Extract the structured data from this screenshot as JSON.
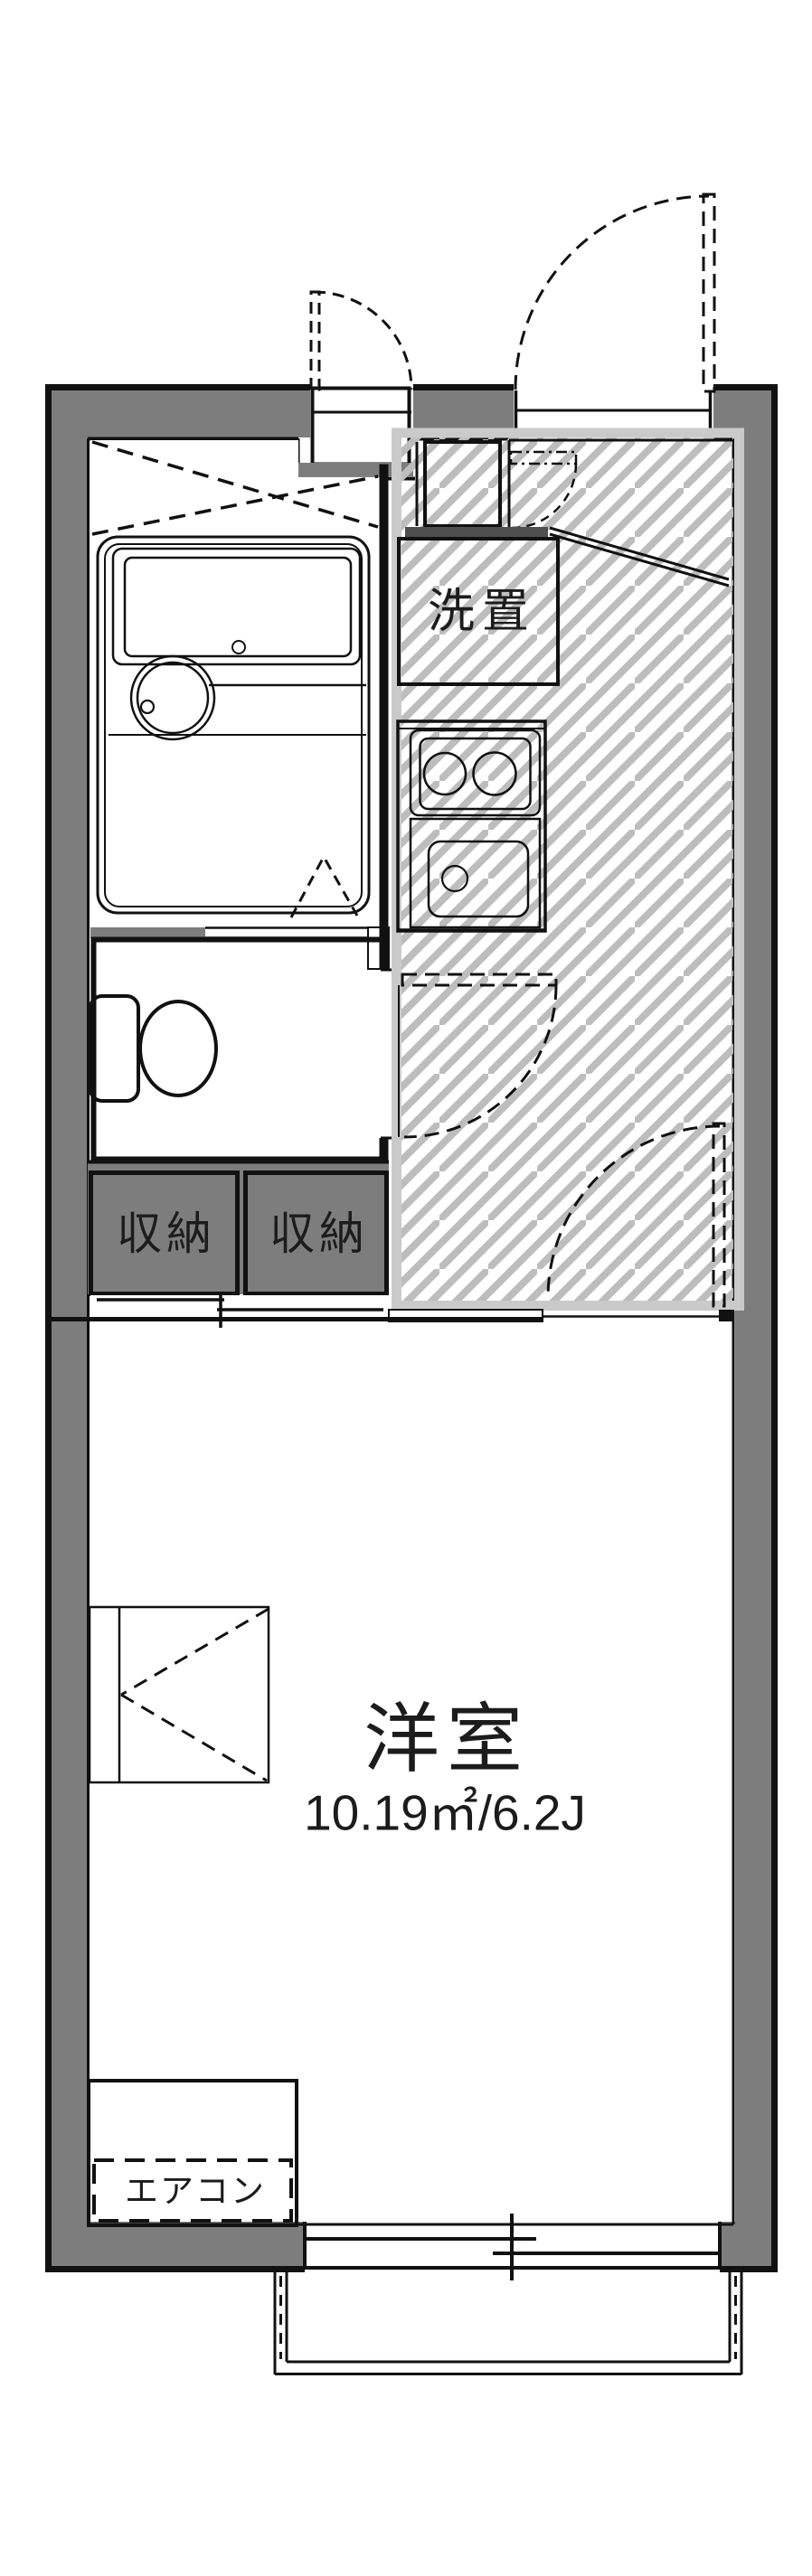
{
  "plan": {
    "labels": {
      "washer_space": "洗置",
      "storage_left": "収納",
      "storage_right": "収納",
      "main_room_name": "洋室",
      "main_room_area": "10.19㎡/6.2J",
      "air_conditioner": "エアコン"
    },
    "colors": {
      "wall_gray": "#7d7d7d",
      "dark_gray": "#4f4f4f",
      "fixture_blue": "#dde9f7",
      "tub_blue": "#ecf2fb",
      "storage_cream": "#f9edd2",
      "hatch_gray": "#bdbdbd",
      "hatch_frame": "#cacaca",
      "line_black": "#111111"
    }
  }
}
